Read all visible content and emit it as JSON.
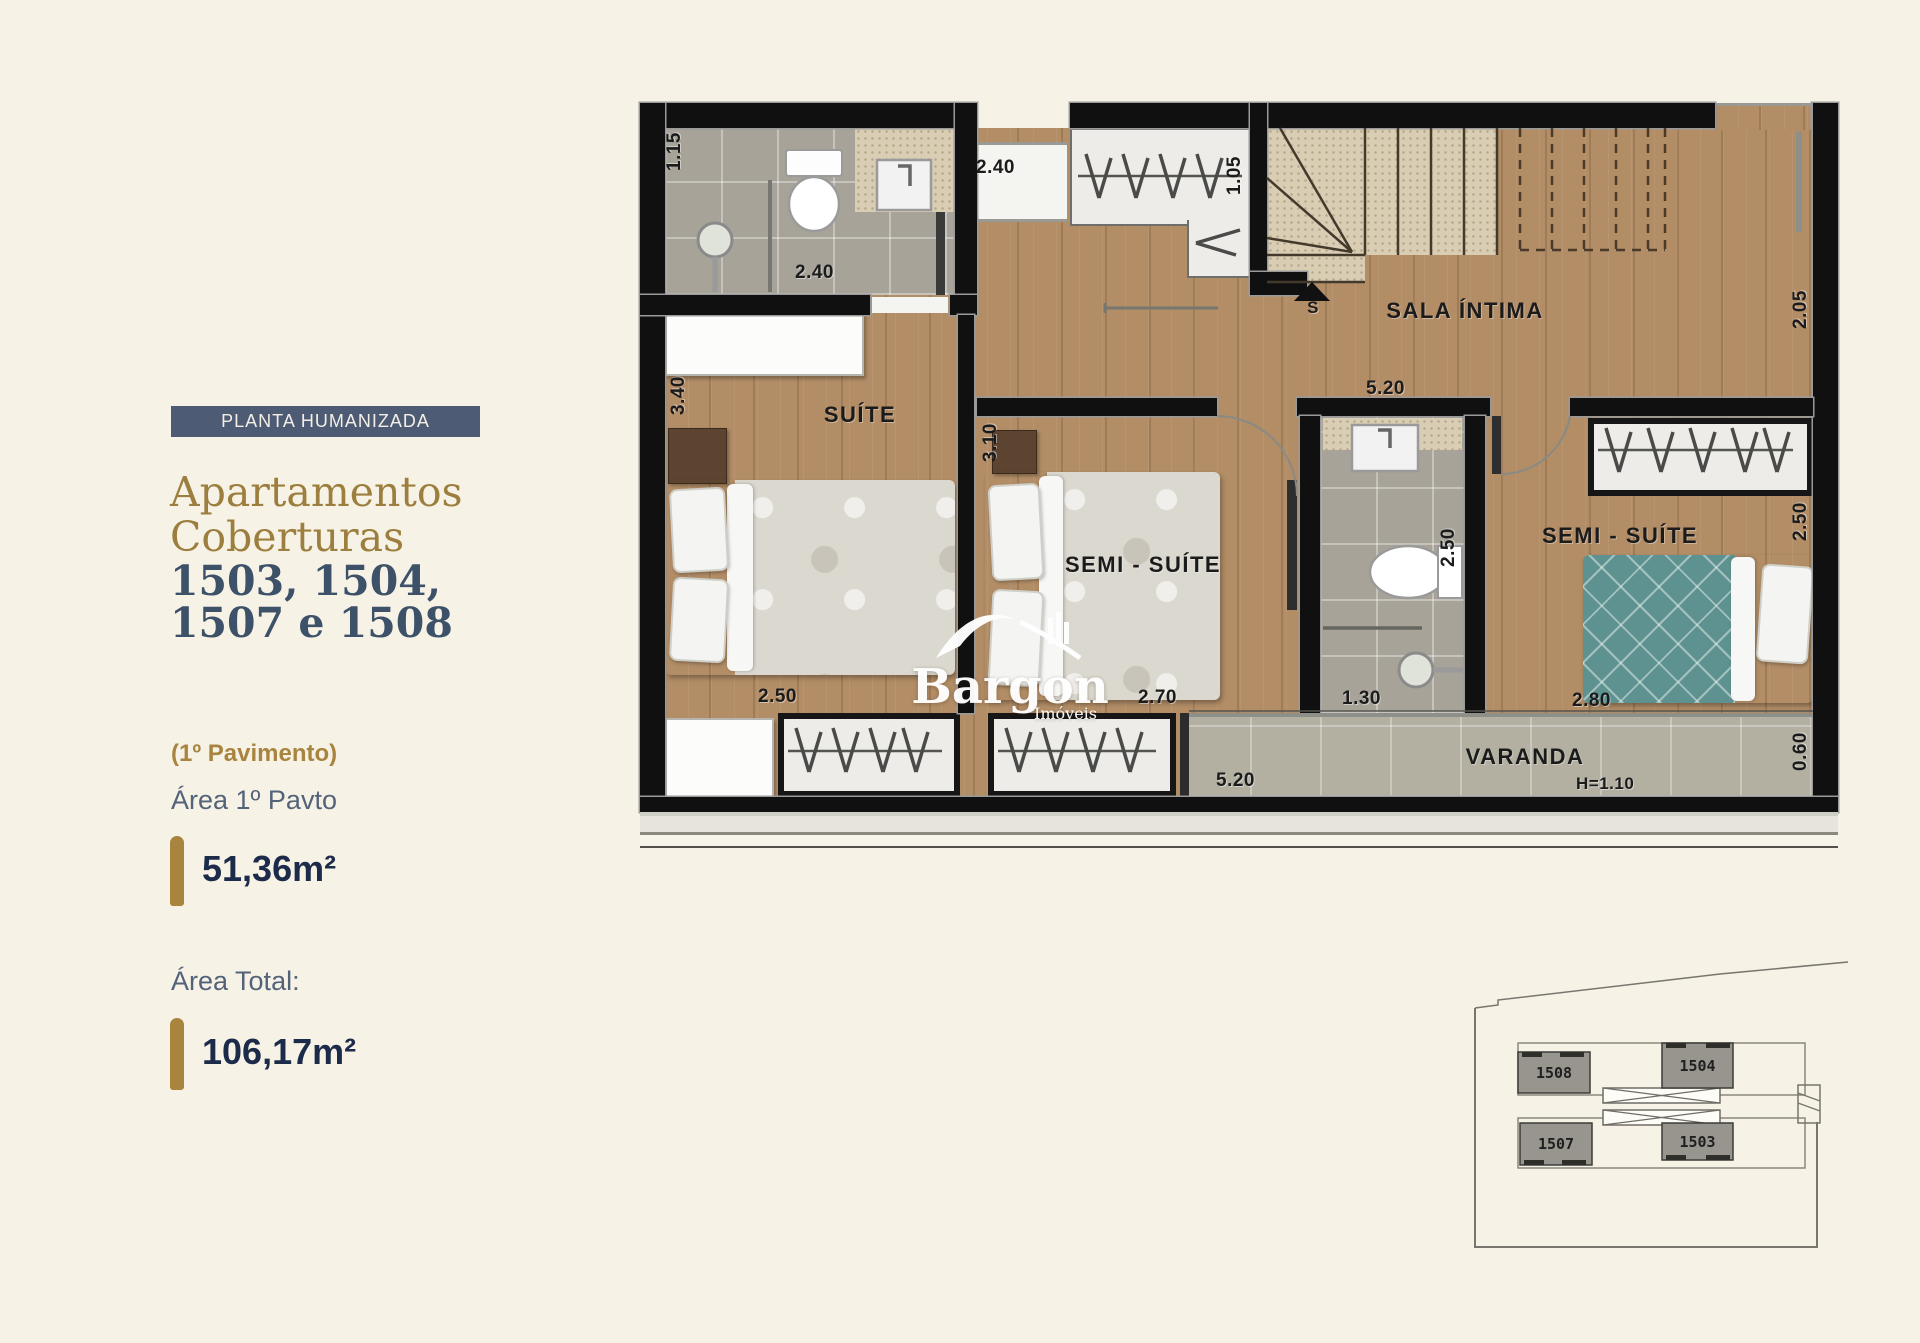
{
  "sidebar": {
    "badge": "PLANTA HUMANIZADA",
    "title_line1": "Apartamentos",
    "title_line2": "Coberturas",
    "units_line1": "1503, 1504,",
    "units_line2": "1507 e 1508",
    "floor_note": "(1º Pavimento)",
    "area_floor_label": "Área 1º Pavto",
    "area_floor_value": "51,36m²",
    "area_total_label": "Área Total:",
    "area_total_value": "106,17m²"
  },
  "plan": {
    "room_suite": "SUÍTE",
    "room_semi1": "SEMI - SUÍTE",
    "room_semi2": "SEMI - SUÍTE",
    "room_sala": "SALA ÍNTIMA",
    "room_varanda": "VARANDA",
    "stair_marker": "S",
    "varanda_rail_height": "H=1.10",
    "dim_shower": "1.15",
    "dim_bath1": "2.40",
    "dim_hall": "2.40",
    "dim_closet_top": "1.05",
    "dim_entry": "2.05",
    "dim_suite_h": "3.40",
    "dim_semi1_h": "3.10",
    "dim_sala_w": "5.20",
    "dim_suite_w": "2.50",
    "dim_semi1_w": "2.70",
    "dim_bath2_h": "2.50",
    "dim_bath2_w": "1.30",
    "dim_semi2_h": "2.50",
    "dim_semi2_w": "2.80",
    "dim_varanda_w": "5.20",
    "dim_varanda_h": "0.60"
  },
  "logo": {
    "name": "Bargon",
    "tagline": "Imóveis"
  },
  "keyplan": {
    "unit_tl": "1508",
    "unit_tr": "1504",
    "unit_bl": "1507",
    "unit_br": "1503"
  },
  "colors": {
    "background": "#f7f2e6",
    "badge_bg": "#4d5b74",
    "gold": "#a8843e",
    "navy": "#1b2b49",
    "slate": "#53637a",
    "wood": "#b28d66",
    "teal_bed": "#5e9290"
  }
}
